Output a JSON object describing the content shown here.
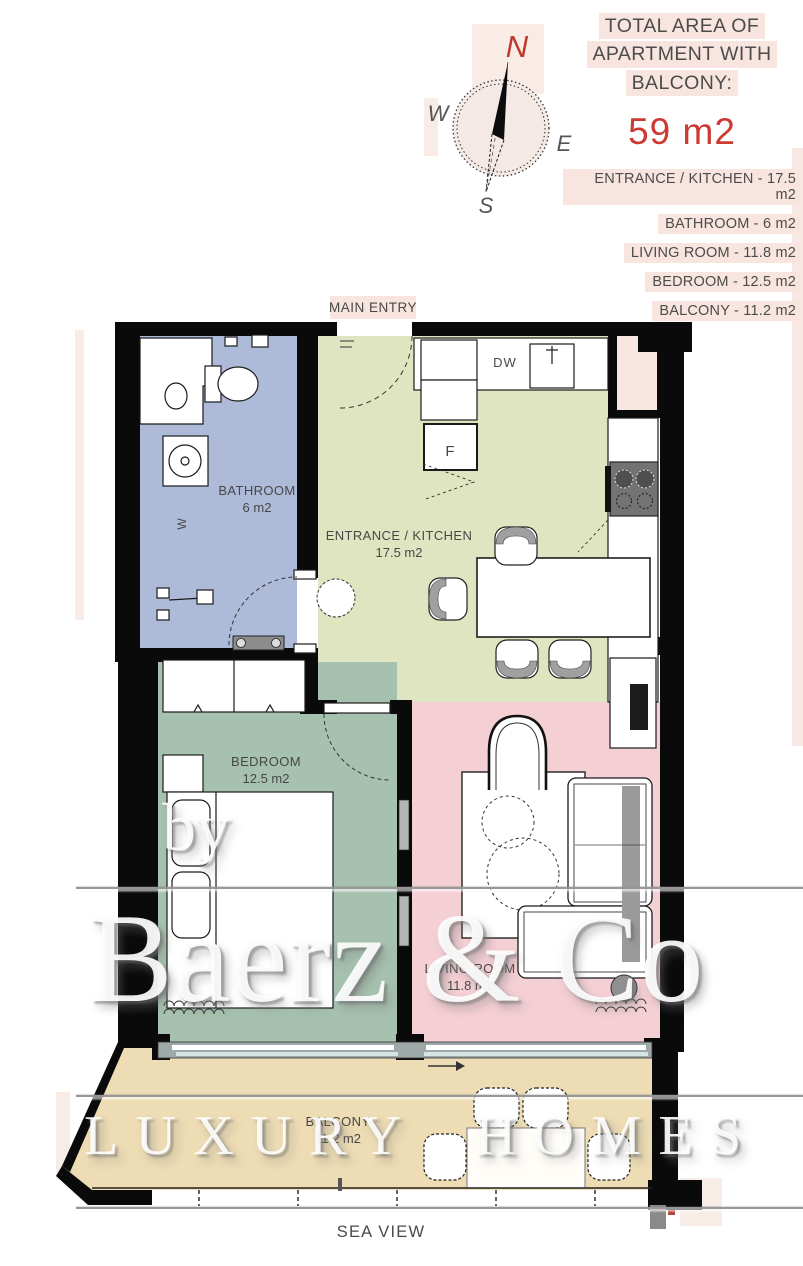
{
  "header": {
    "title_line1": "TOTAL AREA OF",
    "title_line2": "APARTMENT WITH",
    "title_line3": "BALCONY:",
    "total_area": "59 m2",
    "areas": [
      "ENTRANCE / KITCHEN - 17.5 m2",
      "BATHROOM - 6 m2",
      "LIVING ROOM - 11.8 m2",
      "BEDROOM - 12.5 m2",
      "BALCONY - 11.2 m2"
    ],
    "accent_red": "#cd3a33",
    "text_gray": "#4c4c4c",
    "highlight_pink": "#f8e5df"
  },
  "compass": {
    "north": "N",
    "east": "E",
    "south": "S",
    "west": "W"
  },
  "plan": {
    "main_entry": "MAIN ENTRY",
    "sea_view": "SEA VIEW",
    "rooms": {
      "bathroom": {
        "name": "BATHROOM",
        "area": "6 m2",
        "color": "#adbbd8"
      },
      "kitchen": {
        "name": "ENTRANCE / KITCHEN",
        "area": "17.5 m2",
        "color": "#dfe5c0"
      },
      "bedroom": {
        "name": "BEDROOM",
        "area": "12.5 m2",
        "color": "#a6c1af"
      },
      "living": {
        "name": "LIVING ROOM",
        "area": "11.8 m2",
        "color": "#f4cfd4"
      },
      "balcony": {
        "name": "BALCONY",
        "area": "11.2 m2",
        "color": "#eddcb4"
      }
    },
    "appliances": {
      "dishwasher": "DW",
      "fridge": "F",
      "washer": "W"
    }
  },
  "watermark": {
    "by": "by",
    "brand": "Baerz & Co",
    "tagline": "LUXURY HOMES"
  }
}
